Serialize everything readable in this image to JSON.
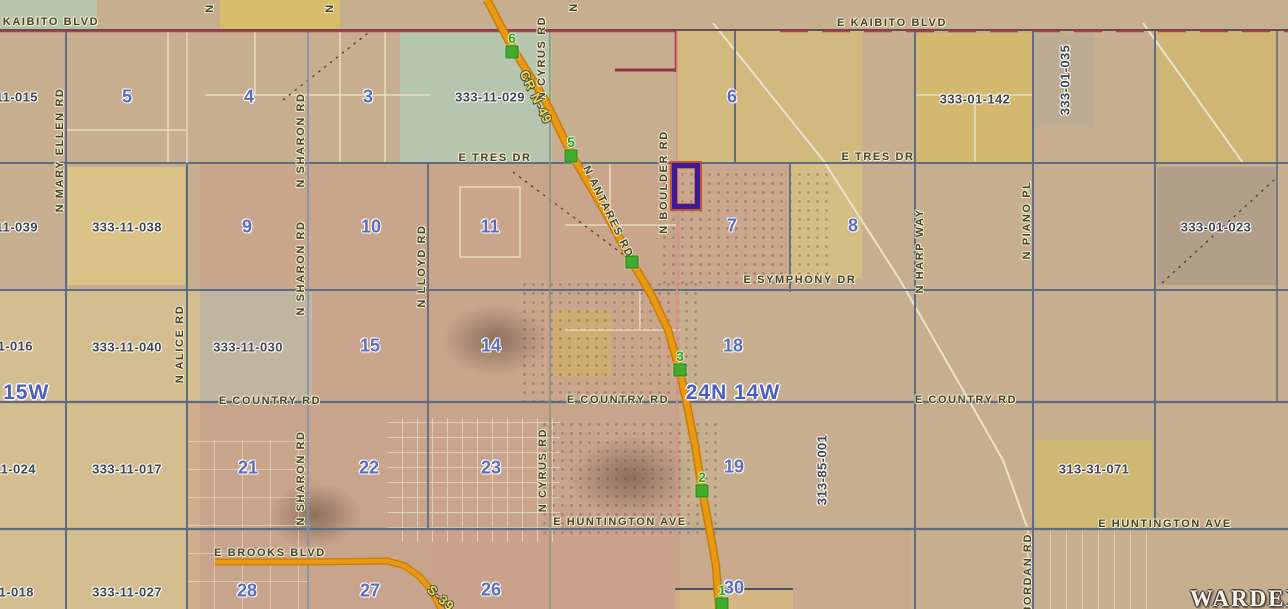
{
  "map": {
    "watermark": "WARDEX",
    "township_labels": [
      {
        "text": "24N 14W",
        "x": 733,
        "y": 393
      },
      {
        "text": "24N 15W",
        "x": 2,
        "y": 393
      }
    ],
    "parcel_ids": [
      {
        "text": "333-11-015",
        "x": 3,
        "y": 97
      },
      {
        "text": "333-11-029",
        "x": 490,
        "y": 97
      },
      {
        "text": "333-01-142",
        "x": 975,
        "y": 99
      },
      {
        "text": "333-11-039",
        "x": 3,
        "y": 227
      },
      {
        "text": "333-11-038",
        "x": 127,
        "y": 227
      },
      {
        "text": "333-01-023",
        "x": 1216,
        "y": 227
      },
      {
        "text": "333-11-016",
        "x": -2,
        "y": 346
      },
      {
        "text": "333-11-040",
        "x": 127,
        "y": 347
      },
      {
        "text": "333-11-030",
        "x": 248,
        "y": 347
      },
      {
        "text": "333-11-024",
        "x": 1,
        "y": 469
      },
      {
        "text": "333-11-017",
        "x": 127,
        "y": 469
      },
      {
        "text": "313-31-071",
        "x": 1094,
        "y": 469
      },
      {
        "text": "333-11-018",
        "x": -1,
        "y": 592
      },
      {
        "text": "333-11-027",
        "x": 127,
        "y": 592
      }
    ],
    "parcel_ids_vertical": [
      {
        "text": "333-01-035",
        "x": 1065,
        "y": 80
      },
      {
        "text": "313-85-001",
        "x": 822,
        "y": 470
      }
    ],
    "section_numbers": [
      {
        "text": "5",
        "x": 127,
        "y": 97
      },
      {
        "text": "4",
        "x": 249,
        "y": 97
      },
      {
        "text": "3",
        "x": 368,
        "y": 97
      },
      {
        "text": "6",
        "x": 732,
        "y": 97
      },
      {
        "text": "9",
        "x": 247,
        "y": 227
      },
      {
        "text": "10",
        "x": 371,
        "y": 227
      },
      {
        "text": "11",
        "x": 490,
        "y": 227
      },
      {
        "text": "7",
        "x": 732,
        "y": 226
      },
      {
        "text": "8",
        "x": 853,
        "y": 226
      },
      {
        "text": "15",
        "x": 370,
        "y": 346
      },
      {
        "text": "14",
        "x": 491,
        "y": 346
      },
      {
        "text": "18",
        "x": 733,
        "y": 346
      },
      {
        "text": "21",
        "x": 248,
        "y": 468
      },
      {
        "text": "22",
        "x": 369,
        "y": 468
      },
      {
        "text": "23",
        "x": 491,
        "y": 468
      },
      {
        "text": "19",
        "x": 734,
        "y": 467
      },
      {
        "text": "26",
        "x": 491,
        "y": 590
      },
      {
        "text": "27",
        "x": 370,
        "y": 591
      },
      {
        "text": "28",
        "x": 247,
        "y": 591
      },
      {
        "text": "30",
        "x": 734,
        "y": 588
      }
    ],
    "street_labels": [
      {
        "text": "KAIBITO BLVD",
        "x": 51,
        "y": 22
      },
      {
        "text": "E KAIBITO BLVD",
        "x": 892,
        "y": 23
      },
      {
        "text": "E TRES DR",
        "x": 495,
        "y": 158
      },
      {
        "text": "E TRES DR",
        "x": 878,
        "y": 157
      },
      {
        "text": "E SYMPHONY DR",
        "x": 800,
        "y": 280
      },
      {
        "text": "E COUNTRY RD",
        "x": 270,
        "y": 401
      },
      {
        "text": "E COUNTRY RD",
        "x": 618,
        "y": 400
      },
      {
        "text": "E COUNTRY RD",
        "x": 966,
        "y": 400
      },
      {
        "text": "E HUNTINGTON AVE",
        "x": 620,
        "y": 522
      },
      {
        "text": "E HUNTINGTON AVE",
        "x": 1165,
        "y": 524
      },
      {
        "text": "E BROOKS BLVD",
        "x": 270,
        "y": 553
      }
    ],
    "street_labels_vertical": [
      {
        "text": "N MARY ELLEN RD",
        "x": 60,
        "y": 150
      },
      {
        "text": "N SHARON RD",
        "x": 301,
        "y": 140
      },
      {
        "text": "N SHARON RD",
        "x": 301,
        "y": 268
      },
      {
        "text": "N SHARON RD",
        "x": 301,
        "y": 478
      },
      {
        "text": "N ALICE RD",
        "x": 180,
        "y": 344
      },
      {
        "text": "N LLOYD RD",
        "x": 422,
        "y": 266
      },
      {
        "text": "N CYRUS RD",
        "x": 542,
        "y": 58
      },
      {
        "text": "N CYRUS RD",
        "x": 543,
        "y": 470
      },
      {
        "text": "N BOULDER RD",
        "x": 664,
        "y": 182
      },
      {
        "text": "N HARP WAY",
        "x": 920,
        "y": 251
      },
      {
        "text": "N PIANO PL",
        "x": 1027,
        "y": 220
      },
      {
        "text": "N JORDAN RD",
        "x": 1028,
        "y": 580
      },
      {
        "text": "N",
        "x": 210,
        "y": 8
      },
      {
        "text": "N",
        "x": 330,
        "y": 8
      },
      {
        "text": "N",
        "x": 574,
        "y": 7
      }
    ],
    "street_labels_rotated": [
      {
        "text": "CR N-49",
        "x": 536,
        "y": 97,
        "angle": 64,
        "style": "highway"
      },
      {
        "text": "N ANTARES RD",
        "x": 608,
        "y": 212,
        "angle": 64,
        "style": "street"
      },
      {
        "text": "S-39",
        "x": 441,
        "y": 598,
        "angle": 42,
        "style": "highway"
      }
    ],
    "markers": [
      {
        "label": "6",
        "x": 512,
        "y": 52
      },
      {
        "label": "5",
        "x": 571,
        "y": 156
      },
      {
        "label": "",
        "x": 632,
        "y": 262
      },
      {
        "label": "3",
        "x": 680,
        "y": 370
      },
      {
        "label": "2",
        "x": 702,
        "y": 491
      },
      {
        "label": "1",
        "x": 722,
        "y": 604
      }
    ],
    "highlight": {
      "x": 672,
      "y": 163,
      "w": 18,
      "h": 36
    },
    "colors": {
      "highway_orange": "#ea9812",
      "marker_green": "#3fae2a",
      "section_number_blue": "#5a6cc0",
      "township_blue": "#4c5ec2",
      "highlight_purple": "#3a1c99",
      "highlight_outline": "#c14f2a",
      "section_line": "#5d6c7e",
      "kaibito_red": "#c03850",
      "street_label": "#45432c",
      "parcel_label": "#43454e"
    }
  }
}
